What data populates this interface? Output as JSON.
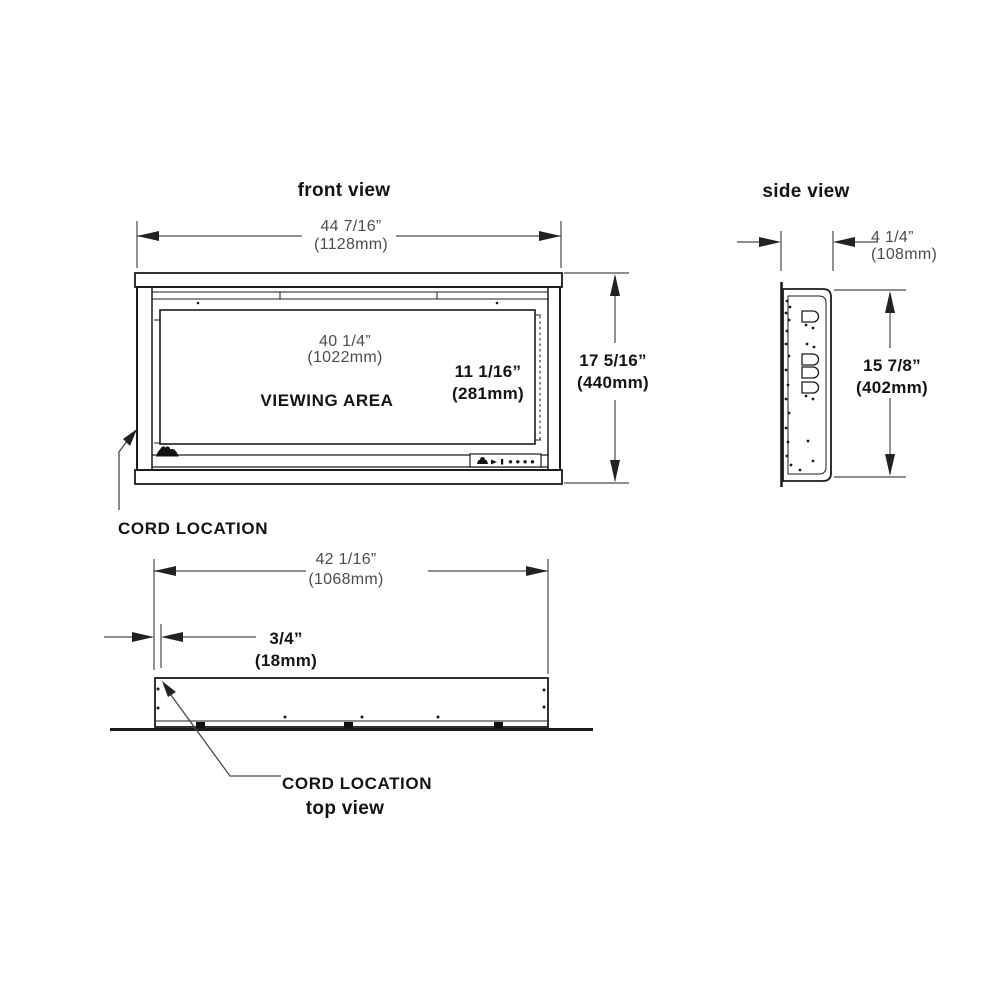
{
  "drawing": {
    "front_view": {
      "title": "front view",
      "overall_width": {
        "inches": "44 7/16”",
        "mm": "(1128mm)"
      },
      "viewing_width": {
        "inches": "40 1/4”",
        "mm": "(1022mm)"
      },
      "viewing_height": {
        "inches": "11 1/16”",
        "mm": "(281mm)"
      },
      "overall_height": {
        "inches": "17 5/16”",
        "mm": "(440mm)"
      },
      "viewing_area_label": "VIEWING AREA",
      "cord_location_label": "CORD LOCATION"
    },
    "side_view": {
      "title": "side view",
      "depth": {
        "inches": "4 1/4”",
        "mm": "(108mm)"
      },
      "height": {
        "inches": "15 7/8”",
        "mm": "(402mm)"
      }
    },
    "top_view": {
      "title": "top view",
      "width": {
        "inches": "42 1/16”",
        "mm": "(1068mm)"
      },
      "cord_offset": {
        "inches": "3/4”",
        "mm": "(18mm)"
      },
      "cord_location_label": "CORD LOCATION"
    },
    "icons": {
      "hearth_flame": "flame-icon",
      "control_panel": "control-buttons-icon"
    },
    "colors": {
      "drawing_line": "#1c1c1c",
      "dimension_line": "#4a4a4a",
      "dimension_text": "#4d4d4d",
      "label_text": "#141414",
      "background": "#ffffff"
    }
  }
}
